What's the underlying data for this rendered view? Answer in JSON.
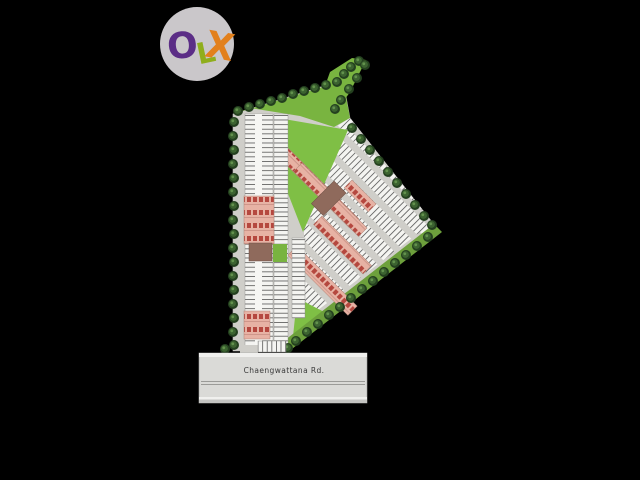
{
  "background": "#000000",
  "logo": {
    "text": "OLX",
    "circle_color": "#cac7ca",
    "letters": [
      {
        "char": "O",
        "color": "#5b2d86"
      },
      {
        "char": "L",
        "color": "#8fae1c"
      },
      {
        "char": "X",
        "color": "#e2801c"
      }
    ]
  },
  "site_plan": {
    "road_label": "Chaengwattana Rd.",
    "colors": {
      "pavement": "#cfcec9",
      "parking_white": "#f4f4f1",
      "stall_line": "#565656",
      "lawn": "#79b440",
      "lawn_bright": "#7fbf45",
      "lawn_dark": "#6da03c",
      "tree_dark": "#24401f",
      "tree_mid": "#3c6330",
      "tree_light": "#63924d",
      "building_pink": "#e7b2a4",
      "building_unit_red": "#b5483f",
      "building_brown": "#8f6a5c",
      "road_surface": "#dadad7",
      "road_line_white": "#f0f0ee",
      "road_divider": "#9b9b98",
      "label_text": "#3a3a3a"
    }
  }
}
